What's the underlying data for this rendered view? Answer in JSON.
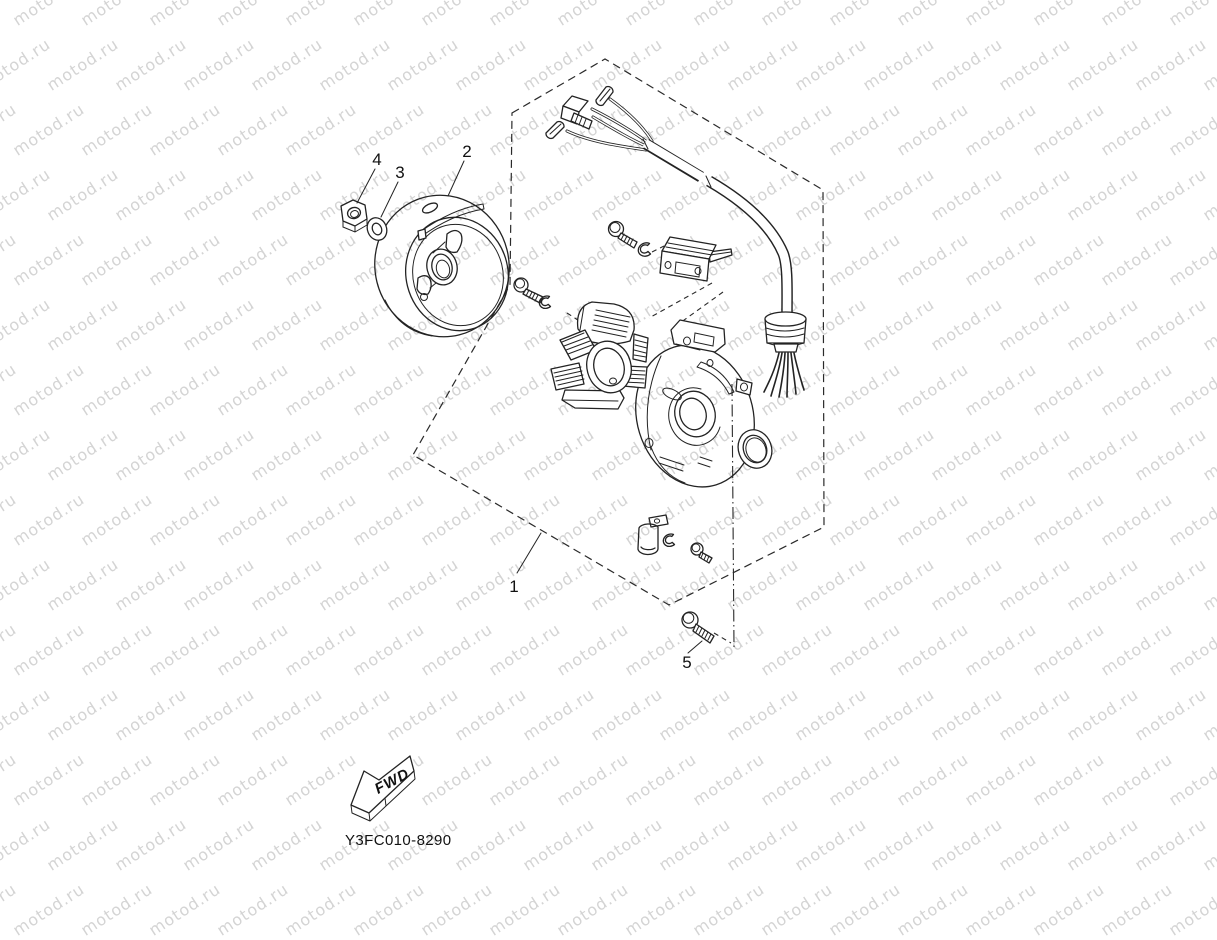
{
  "watermark": {
    "text": "motod.ru",
    "color": "#d4d4d4",
    "font_size_px": 16,
    "rotation_deg": -33,
    "col_spacing": 68,
    "row_spacing": 65,
    "row_stagger": 34
  },
  "figure": {
    "code": "Y3FC010-8290",
    "direction_label": "FWD",
    "callouts": {
      "1": "1",
      "2": "2",
      "3": "3",
      "4": "4",
      "5": "5"
    }
  },
  "colors": {
    "line": "#232323",
    "background": "#ffffff",
    "text": "#111111"
  }
}
